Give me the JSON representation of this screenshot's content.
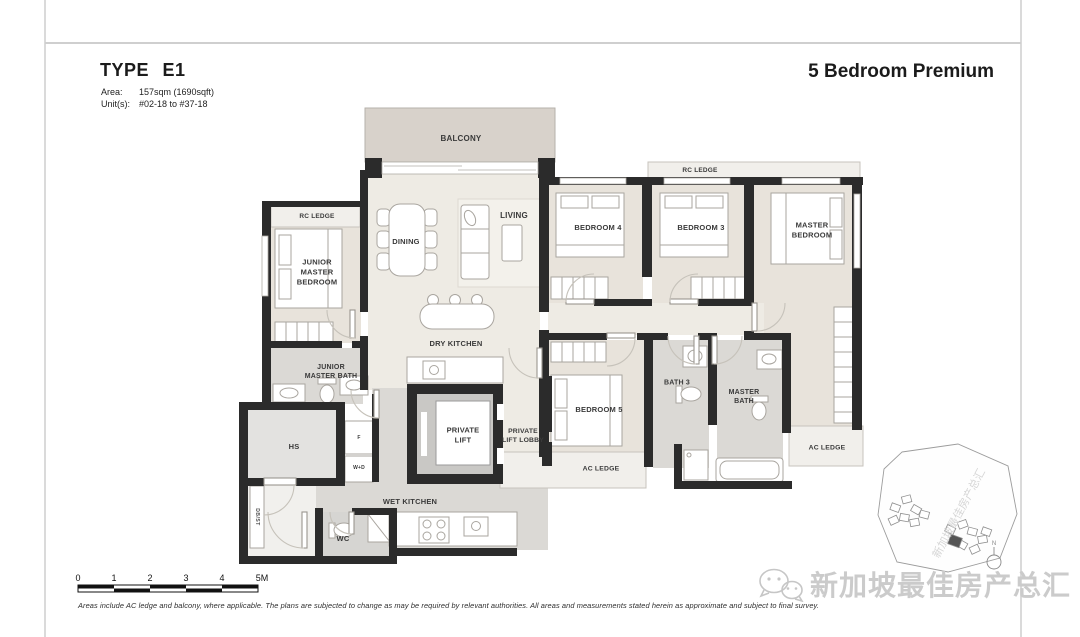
{
  "header": {
    "type_title": "TYPE E1",
    "area_label": "Area:",
    "area_value": "157sqm (1690sqft)",
    "units_label": "Unit(s):",
    "units_value": "#02-18 to #37-18",
    "category": "5 Bedroom Premium"
  },
  "plan": {
    "balcony": "BALCONY",
    "living": "LIVING",
    "dining": "DINING",
    "dry_kitchen": "DRY KITCHEN",
    "wet_kitchen": "WET KITCHEN",
    "bedroom_4": "BEDROOM 4",
    "bedroom_3": "BEDROOM 3",
    "bedroom_5": "BEDROOM 5",
    "master_bedroom": "MASTER BEDROOM",
    "junior_master_bedroom": "JUNIOR MASTER BEDROOM",
    "junior_master_bath": "JUNIOR MASTER BATH",
    "master_bath": "MASTER BATH",
    "bath_3": "BATH 3",
    "private_lift": "PRIVATE LIFT",
    "private_lift_lobby": "PRIVATE LIFT LOBBY",
    "hs": "HS",
    "wc": "WC",
    "rc_ledge_left": "RC LEDGE",
    "rc_ledge_right": "RC LEDGE",
    "ac_ledge_left": "AC LEDGE",
    "ac_ledge_right": "AC LEDGE",
    "fridge": "F",
    "washer_dryer": "W+D",
    "db_st": "DB/ST"
  },
  "scale_bar": {
    "ticks": [
      "0",
      "1",
      "2",
      "3",
      "4",
      "5M"
    ]
  },
  "compass": {
    "label": "N"
  },
  "watermark": {
    "text": "新加坡最佳房产总汇"
  },
  "footer": {
    "disclaimer": "Areas include AC ledge and balcony, where applicable. The plans are subjected to change as may be required by relevant authorities. All areas and measurements stated herein as approximate and subject to final survey."
  },
  "colors": {
    "wall": "#2b2b2b",
    "floor": "#eeebe4",
    "bedroom_floor": "#e8e3db",
    "bath_floor": "#dbd9d5",
    "balcony": "#d8d2cb",
    "ledge": "#f1efeb",
    "lift_shaft": "#c9c8c5",
    "watermark": "#cbcbcb"
  }
}
